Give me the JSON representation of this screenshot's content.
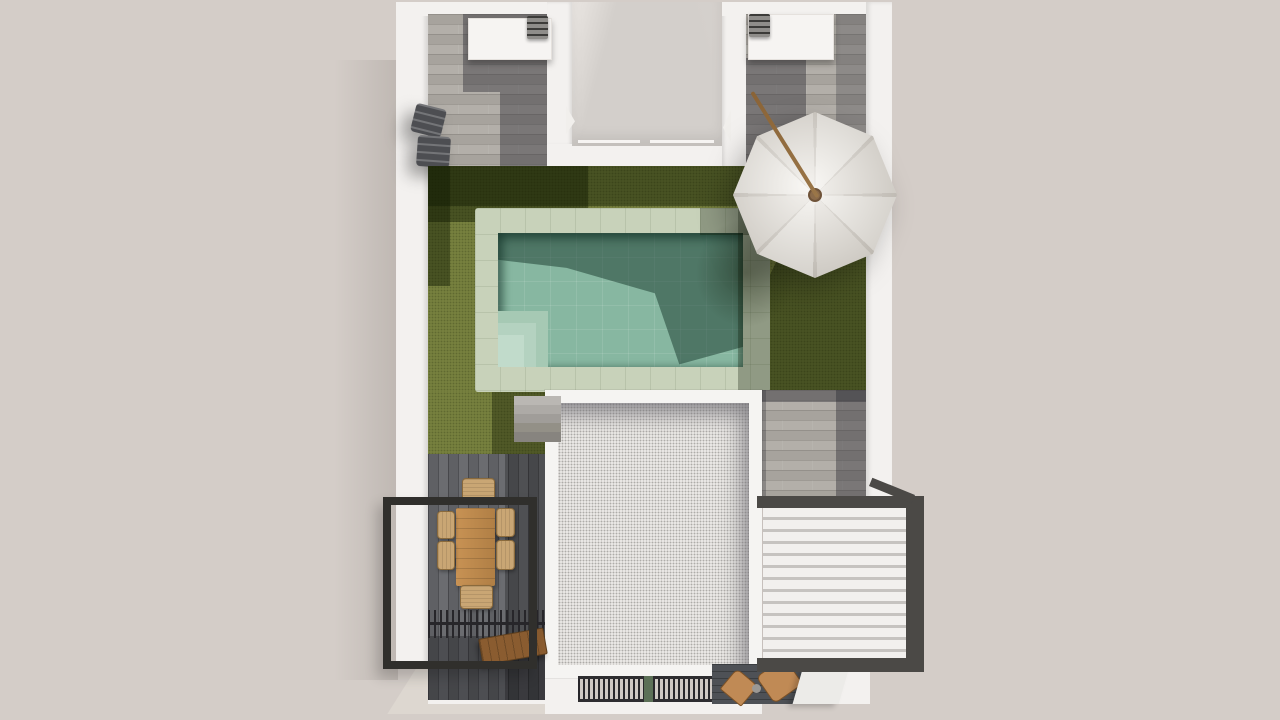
{
  "scene": {
    "type": "architectural-3d-top-view-render",
    "objects": [
      {
        "name": "perimeter-walls",
        "label": "white perimeter walls"
      },
      {
        "name": "upper-terrace-left",
        "label": "upper roof terrace with wood-look tile"
      },
      {
        "name": "upper-terrace-right",
        "label": "upper roof terrace with wood-look tile"
      },
      {
        "name": "bbq-counter-left",
        "label": "white outdoor kitchen counter with grill"
      },
      {
        "name": "bbq-counter-right",
        "label": "white outdoor kitchen counter with grill"
      },
      {
        "name": "courtyard-void",
        "label": "open courtyard void to lower level"
      },
      {
        "name": "lawn",
        "label": "green lawn"
      },
      {
        "name": "swimming-pool",
        "label": "rectangular pool with stone coping and corner steps"
      },
      {
        "name": "parasol",
        "label": "white eight-panel parasol on tilted wood mast"
      },
      {
        "name": "sun-loungers",
        "label": "two dark sun loungers against left wall"
      },
      {
        "name": "gravel-roof",
        "label": "white gravel flat roof with parapet"
      },
      {
        "name": "staircase",
        "label": "concrete stairs beside roof"
      },
      {
        "name": "wood-deck",
        "label": "dark wood deck dining area"
      },
      {
        "name": "dining-set",
        "label": "wood table with six wicker chairs"
      },
      {
        "name": "steel-pergola-frame",
        "label": "black steel pergola frame"
      },
      {
        "name": "slatted-screen",
        "label": "black slatted screen"
      },
      {
        "name": "wood-bench",
        "label": "wood bench"
      },
      {
        "name": "louvered-pergola",
        "label": "pergola with white louvers and dark frame"
      },
      {
        "name": "entrance-grate",
        "label": "dark slatted grate over entry"
      },
      {
        "name": "potted-plant",
        "label": "small green plant in grate"
      },
      {
        "name": "outdoor-chairs",
        "label": "two wood chairs on lower deck"
      }
    ],
    "details": {
      "dining_chairs": 6,
      "umbrella_panels": 8,
      "louver_slats": 13,
      "stair_steps": 5,
      "pool_corner_steps": 3,
      "grills": 2,
      "sun_loungers": 2
    },
    "colors": {
      "backdrop": "#d4cdc8",
      "paving_light": "#ddd7d1",
      "wall_white": "#f3f1ef",
      "wall_shade": "#e2ddd8",
      "courtyard_floor": "#d3cfcb",
      "tile_a": "#b3afa9",
      "tile_b": "#a7a39d",
      "tile_line": "rgba(60,58,55,0.18)",
      "tile_shadow": "rgba(44,44,50,0.42)",
      "lawn": "#76803e",
      "lawn_speck": "rgba(30,36,8,0.25)",
      "lawn_shadow": "rgba(18,26,2,0.45)",
      "coping": "#c8d2ba",
      "coping_line": "rgba(70,85,55,0.12)",
      "water": "#87b7a1",
      "water_line": "rgba(255,255,255,0.10)",
      "water_shadow": "rgba(10,42,30,0.45)",
      "step1": "#a6c9b4",
      "step2": "#b4d2c0",
      "step3": "#c1dbcb",
      "roof_border": "#f5f4f2",
      "roof_gravel": "#edebe8",
      "roof_speck": "rgba(122,120,117,0.55)",
      "steel_black": "#302f2c",
      "louver_frame": "#4b4946",
      "louver_white": "#f2f0ee",
      "louver_gap": "#c6c3c0",
      "deck_a": "#6b6c70",
      "deck_b": "#5f6064",
      "deck_dark": "#4e5156",
      "deck_line": "rgba(25,25,28,0.35)",
      "table_wood_light": "#c89254",
      "table_wood_dark": "#b07f45",
      "wicker": "#c9a674",
      "wicker_edge": "#8a6a3c",
      "bench_wood": "#8a5c30",
      "grate_dark": "#27262a",
      "grate_gap": "#cfc9c4",
      "plant_green": "#5c7057",
      "umbrella_a": "#f3f0ea",
      "umbrella_b": "#e9e5de",
      "umbrella_rib": "#d3cec6",
      "umbrella_knob": "#8b6b4a",
      "mast_wood": "#9a7648",
      "grill_body": "#8f8d8a",
      "grill_dark": "#3c3b39",
      "lounger": "#4d4e52"
    }
  }
}
